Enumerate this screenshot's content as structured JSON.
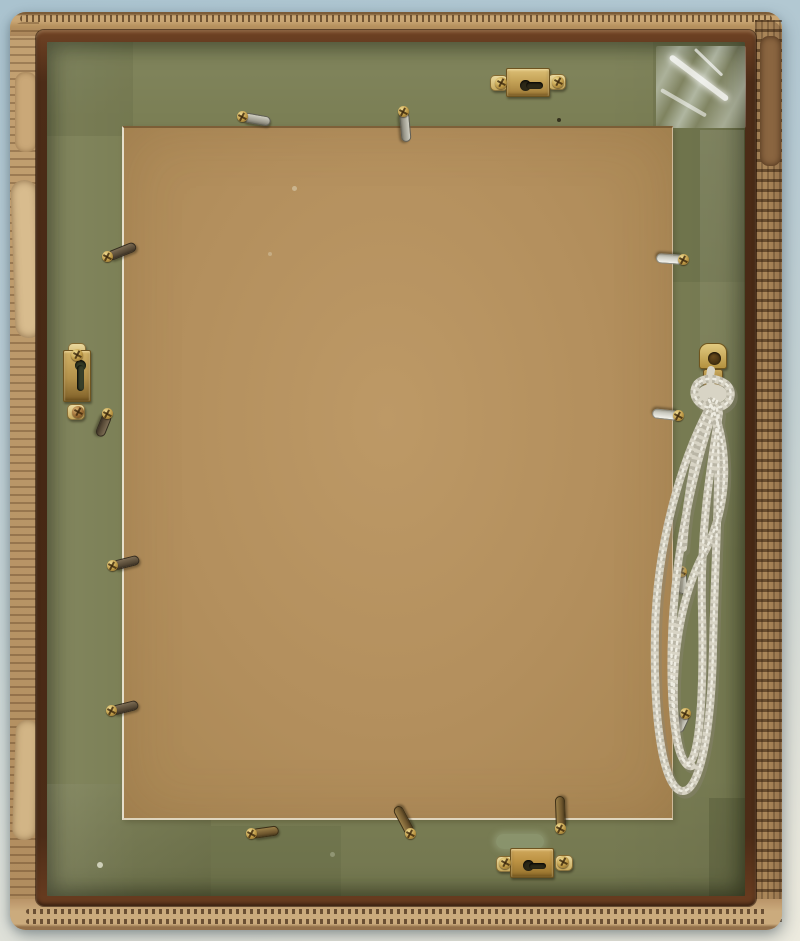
{
  "scene": {
    "title": "Back of a framed picture resting in a corrugated cardboard box lid",
    "type": "photograph",
    "palette": {
      "background_top": "#aac3cf",
      "background_bottom": "#edebdf",
      "cardboard": "#bb9568",
      "wood_edge": "#4c2c17",
      "frame_back_green": "#7b7f55",
      "backing_board": "#b6925f",
      "brass": "#c4a257",
      "cord": "#d8d4c5"
    },
    "objects": {
      "box_label": "corrugated cardboard box lid",
      "frame_label": "wooden frame back painted olive green",
      "board_label": "tan hardboard backing panel",
      "tape_label": "clear shiny tape patch at top-right corner",
      "cord_label": "white braided hanging cord coiled at right side",
      "hanger_count": 4,
      "clip_count": 13
    },
    "hangers": [
      {
        "id": "top",
        "type": "keyhole-hanger-horizontal",
        "x": 488,
        "y": 66
      },
      {
        "id": "left",
        "type": "keyhole-hanger-vertical",
        "x": 59,
        "y": 342
      },
      {
        "id": "bottom",
        "type": "keyhole-hanger-horizontal",
        "x": 494,
        "y": 846
      },
      {
        "id": "right",
        "type": "strap-hanger",
        "x": 699,
        "y": 343
      }
    ],
    "clips": [
      {
        "x": 243,
        "y": 117,
        "angle": 10,
        "len": 28,
        "tone": "silver"
      },
      {
        "x": 404,
        "y": 112,
        "angle": 85,
        "len": 30,
        "tone": "silver"
      },
      {
        "x": 108,
        "y": 257,
        "angle": -22,
        "len": 30,
        "tone": "dark"
      },
      {
        "x": 108,
        "y": 414,
        "angle": 112,
        "len": 24,
        "tone": "dark"
      },
      {
        "x": 113,
        "y": 566,
        "angle": -14,
        "len": 27,
        "tone": "dark"
      },
      {
        "x": 112,
        "y": 711,
        "angle": -14,
        "len": 27,
        "tone": "dark"
      },
      {
        "x": 684,
        "y": 260,
        "angle": 184,
        "len": 28,
        "tone": "bright"
      },
      {
        "x": 679,
        "y": 416,
        "angle": 186,
        "len": 27,
        "tone": "bright"
      },
      {
        "x": 682,
        "y": 572,
        "angle": 88,
        "len": 22,
        "tone": "silver"
      },
      {
        "x": 686,
        "y": 714,
        "angle": 115,
        "len": 20,
        "tone": "silver"
      },
      {
        "x": 252,
        "y": 834,
        "angle": -8,
        "len": 27,
        "tone": "darkbrass"
      },
      {
        "x": 411,
        "y": 834,
        "angle": -118,
        "len": 31,
        "tone": "darkbrass"
      },
      {
        "x": 561,
        "y": 829,
        "angle": -92,
        "len": 33,
        "tone": "darkbrass"
      }
    ],
    "specks": [
      {
        "x": 557,
        "y": 118,
        "d": 4,
        "c": "rgba(40,35,20,0.85)"
      },
      {
        "x": 97,
        "y": 862,
        "d": 6,
        "c": "rgba(244,244,228,0.70)"
      },
      {
        "x": 292,
        "y": 186,
        "d": 5,
        "c": "rgba(235,235,215,0.40)"
      },
      {
        "x": 268,
        "y": 252,
        "d": 4,
        "c": "rgba(235,235,215,0.30)"
      },
      {
        "x": 330,
        "y": 852,
        "d": 5,
        "c": "rgba(225,228,205,0.30)"
      }
    ]
  }
}
